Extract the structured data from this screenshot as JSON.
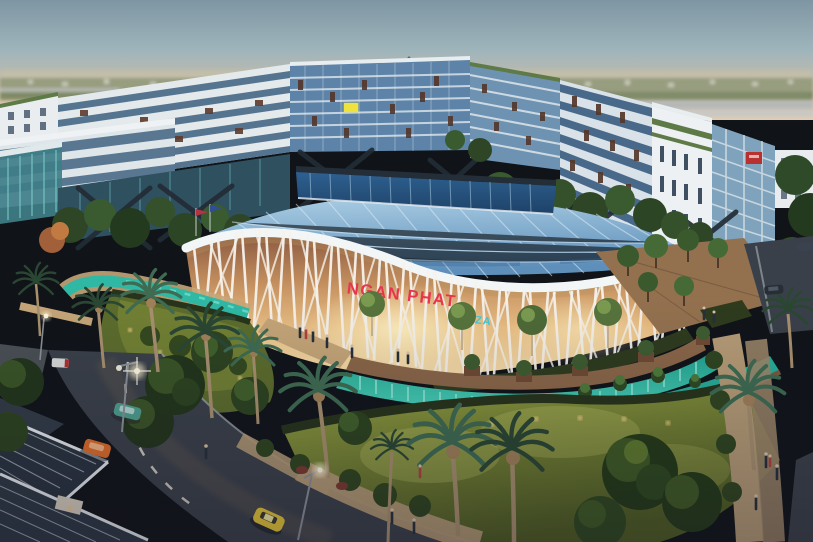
{
  "title": "Aerial dusk architectural rendering of a mixed-use plaza complex",
  "sign": {
    "primary": "NGAN PHAT",
    "secondary": "PLAZA",
    "primary_color": "#E8354E",
    "secondary_color": "#3FC9DC"
  },
  "palette": {
    "sky_top": "#7E96A3",
    "sky_horizon": "#E2CDB2",
    "building_glass": "#5D84A8",
    "building_white": "#E9EDEF",
    "window_accent_brown": "#5E3A2C",
    "mall_facade_glow": "#EBC084",
    "mall_lattice": "#F5F2EC",
    "water_turquoise": "#35C9AE",
    "lawn_green": "#7D8C35",
    "hedge_dark": "#27331A",
    "palm_frond": "#2F5438",
    "asphalt": "#3A4049",
    "pavement": "#B59B76",
    "taxi_yellow": "#E6C838",
    "car_orange": "#DE6C2A",
    "car_green": "#4E9E8E",
    "lamp_glow": "#FFF4D0"
  },
  "scene": {
    "time_of_day": "dusk",
    "view": "aerial three-quarter view",
    "landmark": "oval shopping mall with white organic lattice facade and glass skylight roof",
    "elements": [
      "gradient dusk sky",
      "hazy distant suburb skyline",
      "U-shaped mid-rise building complex with glass curtain walls",
      "oval mall with branching white lattice facade",
      "blue glass skylight roof with raised clerestory",
      "terraced turquoise water cascades with planters",
      "curved turquoise canal",
      "palm-lined lawns and dark hedges",
      "roads with cars and yellow taxi",
      "glowing street lamps and path lights",
      "pedestrians on walkways",
      "house rooftops in lower-left corner",
      "brick plaza with trees on the right"
    ]
  },
  "signage": {
    "rooftop_yellow_sign_color": "#EFE23C",
    "rooftop_red_sign_color": "#B83030"
  },
  "vehicles": {
    "orange_car": "#DE6C2A",
    "green_car": "#4E9E8E",
    "yellow_taxi": "#E6C838",
    "dark_car": "#272E36",
    "white_red_van": "#D8DAD8"
  }
}
